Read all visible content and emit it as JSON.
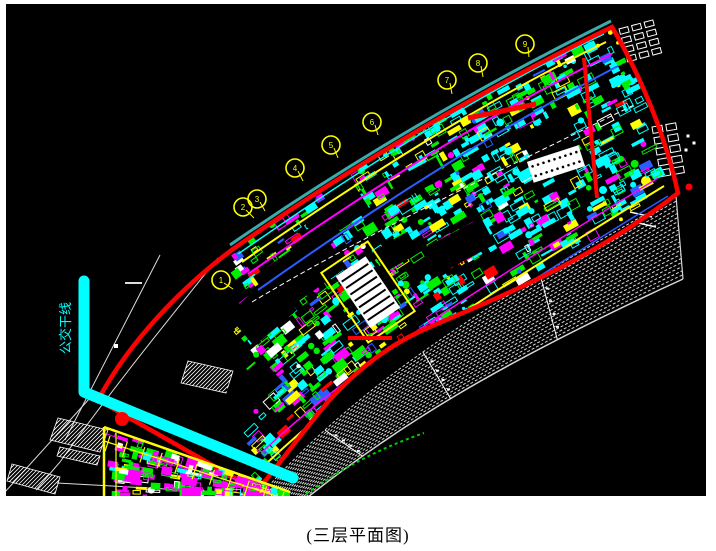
{
  "caption": "(三层平面图)",
  "annotation": {
    "transit_label": "公交干线",
    "color": "#00FFFF"
  },
  "canvas": {
    "x": 6,
    "y": 4,
    "w": 700,
    "h": 492,
    "bg": "#000000"
  },
  "colors": {
    "boundary_red": "#FF0000",
    "teal_edge": "#38ABAB",
    "cyan": "#00FFFF",
    "green": "#00EE00",
    "magenta": "#FF00FF",
    "yellow": "#FFFF00",
    "blue": "#2B5CFF",
    "white": "#FFFFFF",
    "hatch": "#D8D8D8",
    "construction": "#DCDCDC",
    "green_dash": "#00CC00"
  },
  "axis_bubbles": {
    "radius": 9,
    "color": "#FFFF00",
    "items": [
      {
        "x": 221,
        "y": 280,
        "label": "1",
        "lx": 233,
        "ly": 289
      },
      {
        "x": 243,
        "y": 207,
        "label": "2",
        "lx": 254,
        "ly": 218
      },
      {
        "x": 257,
        "y": 199,
        "label": "3",
        "lx": 265,
        "ly": 211
      },
      {
        "x": 295,
        "y": 168,
        "label": "4",
        "lx": 303,
        "ly": 181
      },
      {
        "x": 331,
        "y": 145,
        "label": "5",
        "lx": 338,
        "ly": 158
      },
      {
        "x": 372,
        "y": 122,
        "label": "6",
        "lx": 378,
        "ly": 135
      },
      {
        "x": 447,
        "y": 80,
        "label": "7",
        "lx": 452,
        "ly": 94
      },
      {
        "x": 478,
        "y": 63,
        "label": "8",
        "lx": 483,
        "ly": 77
      },
      {
        "x": 525,
        "y": 44,
        "label": "9",
        "lx": 529,
        "ly": 57
      }
    ]
  },
  "clips": {
    "building": "M233,249 C352,166 478,92 612,27 C642,78 666,138 678,193 C592,260 502,296 432,326 C388,344 352,374 326,404 C306,428 288,452 266,480 L256,490 L98,400 C128,344 178,290 233,249 Z",
    "yblock": "M104,427 L290,492 L290,496 L104,496 Z"
  },
  "layers": [
    {
      "type": "pathgroup",
      "name": "construction-lines",
      "stroke": "#DCDCDC",
      "items": [
        {
          "d": "M218,258 C160,330 110,392 60,462 L36,490",
          "w": 1
        },
        {
          "d": "M160,255 L65,440",
          "w": 1
        },
        {
          "d": "M125,283 L142,283",
          "w": 2
        },
        {
          "d": "M57,483 L220,492",
          "w": 1
        },
        {
          "d": "M90,398 L5,492",
          "w": 1
        }
      ]
    },
    {
      "type": "rects",
      "name": "construction-node",
      "fill": "#FFFFFF",
      "items": [
        [
          116,
          346,
          4,
          4,
          0
        ]
      ]
    },
    {
      "type": "hatchpolys",
      "name": "hatch-patches",
      "color": "#FFFFFF",
      "polys": [
        [
          58,
          418,
          108,
          430,
          100,
          452,
          50,
          440
        ],
        [
          60,
          447,
          100,
          456,
          97,
          465,
          57,
          456
        ],
        [
          188,
          361,
          233,
          371,
          226,
          393,
          181,
          383
        ],
        [
          12,
          464,
          60,
          477,
          55,
          494,
          7,
          481
        ]
      ]
    },
    {
      "type": "fan",
      "name": "terrace-hatch-band",
      "color": "#D8D8D8",
      "dash": "3 2",
      "n": 20,
      "inner": [
        265,
        490,
        360,
        385,
        475,
        310,
        676,
        197
      ],
      "outer": [
        308,
        497,
        395,
        428,
        495,
        365,
        683,
        279
      ],
      "seps": [
        0.2,
        0.48,
        0.75
      ],
      "edge": "M676,196 L683,279"
    },
    {
      "type": "path",
      "name": "green-dashed-line",
      "d": "M306,494 C348,464 384,447 424,433",
      "stroke": "#00CC00",
      "w": 2,
      "dash": "3 3"
    },
    {
      "type": "rectgrid",
      "name": "window-grid-a",
      "x": 619,
      "y": 29,
      "rot": -15,
      "cols": 3,
      "rows": 4,
      "cw": 13,
      "ch": 9.5,
      "rw": 9,
      "rh": 5.5,
      "stroke": "#FFFFFF"
    },
    {
      "type": "rectgrid",
      "name": "window-grid-b",
      "x": 652,
      "y": 127,
      "rot": -10,
      "cols": 2,
      "rows": 5,
      "cw": 14,
      "ch": 11,
      "rw": 10,
      "rh": 6.5,
      "stroke": "#FFFFFF"
    },
    {
      "type": "circle",
      "name": "yellow-marker-dot",
      "cx": 646,
      "cy": 181,
      "r": 5,
      "fill": "#FFFF00"
    },
    {
      "type": "circle",
      "name": "red-marker-small",
      "cx": 689,
      "cy": 187,
      "r": 3.5,
      "fill": "#FF0000"
    },
    {
      "type": "rects",
      "name": "white-dots",
      "fill": "#FFFFFF",
      "items": [
        [
          688,
          136,
          3,
          3,
          0
        ],
        [
          694,
          143,
          3,
          3,
          0
        ],
        [
          686,
          150,
          3,
          3,
          0
        ]
      ]
    },
    {
      "type": "lines",
      "name": "white-dashes",
      "stroke": "#FFFFFF",
      "items": [
        [
          630,
          212,
          652,
          217,
          1.5
        ],
        [
          634,
          222,
          656,
          227,
          1.5
        ]
      ]
    },
    {
      "type": "noise",
      "name": "building-blocks",
      "clip": "building",
      "seed": 7,
      "count": 950,
      "top": [
        233,
        249,
        352,
        166,
        478,
        92,
        612,
        27
      ],
      "bottom": [
        256,
        488,
        360,
        380,
        470,
        305,
        676,
        196
      ],
      "hollow": 0.35,
      "circleChance": 0.08,
      "palette": [
        [
          "#00EE00",
          0.5,
          -0.35
        ],
        [
          "#00FFFF",
          0.1,
          0.55
        ],
        [
          "#FF00FF",
          0.14,
          0
        ],
        [
          "#FFFF00",
          0.13,
          0
        ],
        [
          "#2B5CFF",
          0.08,
          0
        ],
        [
          "#FFFFFF",
          0.06,
          0
        ],
        [
          "#FF0000",
          0.02,
          0
        ]
      ]
    },
    {
      "type": "rects",
      "name": "corridor-gaps",
      "clip": "building",
      "fill": "#000000",
      "items": [
        [
          300,
          272,
          82,
          46,
          -35
        ],
        [
          262,
          312,
          56,
          42,
          -40
        ],
        [
          336,
          214,
          62,
          30,
          -33
        ],
        [
          458,
          247,
          68,
          30,
          -28
        ],
        [
          548,
          141,
          46,
          36,
          -25
        ],
        [
          254,
          386,
          48,
          32,
          -42
        ],
        [
          300,
          441,
          42,
          26,
          -42
        ],
        [
          418,
          179,
          52,
          22,
          -28
        ],
        [
          396,
          252,
          40,
          24,
          -30
        ]
      ]
    },
    {
      "type": "pathgroup",
      "name": "corridor-lines",
      "clip": "building",
      "items": [
        {
          "d": "M238,254 C356,172 474,96 604,34",
          "stroke": "#00FFFF",
          "w": 1.5
        },
        {
          "d": "M242,262 C360,180 478,104 606,42",
          "stroke": "#FFFF00",
          "w": 2
        },
        {
          "d": "M248,274 C366,192 484,116 612,54",
          "stroke": "#FF00FF",
          "w": 2
        },
        {
          "d": "M258,290 C374,208 492,132 618,66",
          "stroke": "#2B5CFF",
          "w": 2
        },
        {
          "d": "M252,302 C356,240 456,192 636,104",
          "stroke": "#FFFFFF",
          "w": 1,
          "dash": "5 3"
        },
        {
          "d": "M268,462 C350,385 430,330 664,186",
          "stroke": "#FFFF00",
          "w": 2
        },
        {
          "d": "M262,452 C344,376 424,322 658,178",
          "stroke": "#FF00FF",
          "w": 1.5
        },
        {
          "d": "M276,472 C354,398 436,338 668,196",
          "stroke": "#2B5CFF",
          "w": 1.5
        }
      ]
    },
    {
      "type": "panel",
      "name": "stair-panel",
      "cx": 368,
      "cy": 292,
      "w": 36,
      "h": 62,
      "rot": -34,
      "fill": "#FFFFFF",
      "bars": 8,
      "barColor": "#000000",
      "ow": 56,
      "oh": 84,
      "ostroke": "#FFFF00"
    },
    {
      "type": "panel",
      "name": "dotted-panel",
      "cx": 556,
      "cy": 164,
      "w": 54,
      "h": 22,
      "rot": -18,
      "fill": "#FFFFFF",
      "dots": [
        2,
        9
      ],
      "dotColor": "#000000"
    },
    {
      "type": "lines",
      "name": "internal-red-lines",
      "stroke": "#FF0000",
      "items": [
        [
          584,
          58,
          597,
          198,
          4
        ],
        [
          468,
          118,
          536,
          104,
          5
        ],
        [
          348,
          338,
          392,
          338,
          4
        ],
        [
          100,
          398,
          280,
          470,
          3
        ]
      ]
    },
    {
      "type": "path",
      "name": "teal-edge-line",
      "d": "M230,245 C352,161 480,86 611,21",
      "stroke": "#38ABAB",
      "w": 3
    },
    {
      "type": "path",
      "name": "building-outline",
      "d": "M233,249 C352,166 478,92 612,27 C642,78 666,138 678,193 C592,260 502,296 432,326 C388,344 352,374 326,404 C306,428 288,452 266,480 L256,490 L98,400 C128,344 178,290 233,249 Z",
      "stroke": "#FF0000",
      "w": 4.5
    },
    {
      "type": "noise",
      "name": "market-blocks",
      "clip": "yblock",
      "seed": 21,
      "count": 170,
      "top": [
        104,
        427,
        166,
        450,
        228,
        471,
        290,
        492
      ],
      "bottom": [
        104,
        496,
        166,
        496,
        228,
        496,
        290,
        496
      ],
      "hollow": 0.3,
      "circleChance": 0.05,
      "palette": [
        [
          "#FF00FF",
          0.42,
          0
        ],
        [
          "#00EE00",
          0.22,
          0
        ],
        [
          "#FFFF00",
          0.16,
          0
        ],
        [
          "#FFFFFF",
          0.1,
          0
        ],
        [
          "#00FFFF",
          0.1,
          0
        ]
      ]
    },
    {
      "type": "pathgroup",
      "name": "yellow-block-frame",
      "stroke": "#FFFF00",
      "items": [
        {
          "d": "M104,427 L290,492",
          "w": 2.5
        },
        {
          "d": "M104,427 L104,496",
          "w": 2.5
        },
        {
          "d": "M116,433 L116,496",
          "w": 1.2
        },
        {
          "d": "M104,441 L276,496",
          "w": 1.2
        }
      ]
    },
    {
      "type": "ticks",
      "name": "yellow-block-ticks",
      "along": [
        110,
        436,
        284,
        492
      ],
      "count": 11,
      "len": 16,
      "stroke": "#FFFF00",
      "w": 1.2
    },
    {
      "type": "path",
      "name": "transit-line",
      "d": "M84,281 L84,392 L293,478",
      "stroke": "#00FFFF",
      "w": 11,
      "cap": "round"
    },
    {
      "type": "circle",
      "name": "red-marker-dot",
      "cx": 122,
      "cy": 419,
      "r": 7,
      "fill": "#FF0000"
    },
    {
      "type": "vtext",
      "name": "transit-line-label",
      "x": 70,
      "y": 354,
      "rot": -90,
      "size": 13,
      "fill": "#00FFFF",
      "bind": "annotation.transit_label"
    }
  ]
}
